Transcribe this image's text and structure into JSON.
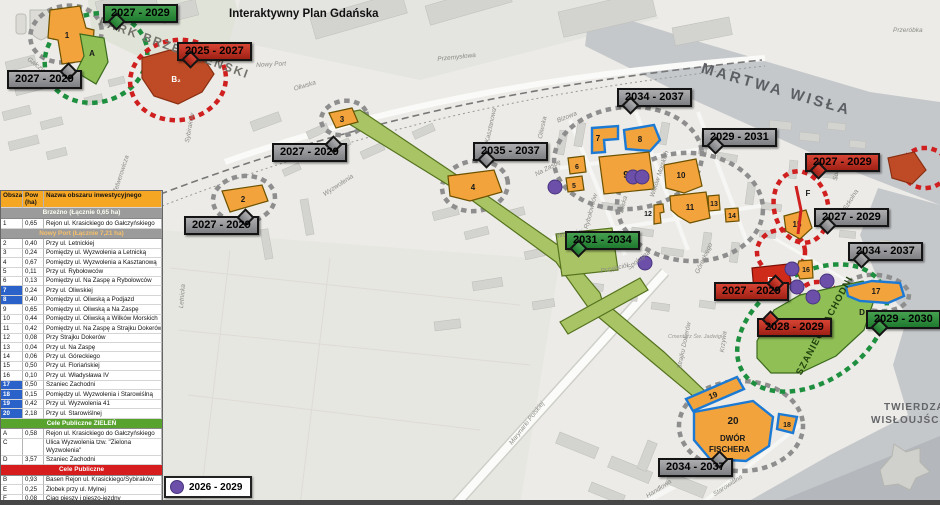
{
  "title": "Interaktywny Plan Gdańska",
  "legend_table": {
    "headers": [
      "Obszar",
      "Pow (ha)",
      "Nazwa obszaru inwestycyjnego"
    ],
    "rows": [
      {
        "section": "Brzeźno (Łącznie 0,65 ha)",
        "variant": "gray"
      },
      {
        "id": "1",
        "area": "0,65",
        "name": "Rejon ul. Krasickiego do Gałczyńskiego"
      },
      {
        "section": "Nowy Port (Łącznie 7,21 ha)",
        "variant": "gray2"
      },
      {
        "id": "2",
        "area": "0,40",
        "name": "Przy ul. Letnickiej"
      },
      {
        "id": "3",
        "area": "0,24",
        "name": "Pomiędzy ul. Wyzwolenia a Letnicką"
      },
      {
        "id": "4",
        "area": "0,67",
        "name": "Pomiędzy ul. Wyzwolenia a Kasztanową"
      },
      {
        "id": "5",
        "area": "0,11",
        "name": "Przy ul. Rybołowców"
      },
      {
        "id": "6",
        "area": "0,13",
        "name": "Pomiędzy ul. Na Zaspę a Rybołowców"
      },
      {
        "id": "7",
        "area": "0,24",
        "name": "Przy ul. Oliwskiej",
        "blue": true
      },
      {
        "id": "8",
        "area": "0,40",
        "name": "Pomiędzy ul. Oliwską a Podjazd",
        "blue": true
      },
      {
        "id": "9",
        "area": "0,65",
        "name": "Pomiędzy ul. Oliwską a Na Zaspę"
      },
      {
        "id": "10",
        "area": "0,44",
        "name": "Pomiędzy ul. Oliwską a Wilków Morskich"
      },
      {
        "id": "11",
        "area": "0,42",
        "name": "Pomiędzy ul. Na Zaspę a Strajku Dokerów"
      },
      {
        "id": "12",
        "area": "0,08",
        "name": "Przy Strajku Dokerów"
      },
      {
        "id": "13",
        "area": "0,04",
        "name": "Przy ul. Na Zaspę"
      },
      {
        "id": "14",
        "area": "0,06",
        "name": "Przy ul. Góreckiego"
      },
      {
        "id": "15",
        "area": "0,50",
        "name": "Przy ul. Floriańskiej"
      },
      {
        "id": "16",
        "area": "0,10",
        "name": "Przy ul. Władysława IV"
      },
      {
        "id": "17",
        "area": "0,50",
        "name": "Szaniec Zachodni",
        "blue": true
      },
      {
        "id": "18",
        "area": "0,15",
        "name": "Pomiędzy ul. Wyzwolenia i Starowiślną",
        "blue": true
      },
      {
        "id": "19",
        "area": "0,42",
        "name": "Przy ul. Wyzwolenia 41",
        "blue": true
      },
      {
        "id": "20",
        "area": "2,18",
        "name": "Przy ul. Starowiślnej",
        "blue": true
      },
      {
        "section": "Cele Publiczne ZIELEŃ",
        "variant": "green"
      },
      {
        "id": "A",
        "area": "0,58",
        "name": "Rejon ul. Krasickiego do Gałczyńskiego"
      },
      {
        "id": "C",
        "area": "",
        "name": "Ulica Wyzwolenia tzw. \"Zielona Wyzwolenia\""
      },
      {
        "id": "D",
        "area": "3,57",
        "name": "Szaniec Zachodni"
      },
      {
        "section": "Cele Publiczne",
        "variant": "red"
      },
      {
        "id": "B",
        "area": "0,93",
        "name": "Basen Rejon ul. Krasickiego/Sybiraków"
      },
      {
        "id": "E",
        "area": "0,25",
        "name": "Żłobek przy ul. Mylnej"
      },
      {
        "id": "F",
        "area": "0,08",
        "name": "Ciąg pieszy i pieszo-jezdny"
      },
      {
        "id": "",
        "area": "",
        "name": "PM nr 1 \"Tęczowa Jedyneczka\""
      },
      {
        "section": "Działki położone w granicach Portu Morskiego",
        "variant": "blue"
      }
    ]
  },
  "dot_legend": {
    "label": "2026 - 2029",
    "color": "#6b4fa8"
  },
  "callouts": [
    {
      "label": "2027 - 2029",
      "variant": "green",
      "x": 103,
      "y": 4,
      "tail": "bl"
    },
    {
      "label": "2025 - 2027",
      "variant": "red",
      "x": 177,
      "y": 42,
      "tail": "bl"
    },
    {
      "label": "2027 - 2029",
      "variant": "gray",
      "x": 7,
      "y": 70,
      "tail": "tr"
    },
    {
      "label": "2027 - 2029",
      "variant": "gray",
      "x": 272,
      "y": 143,
      "tail": "tr"
    },
    {
      "label": "2035 - 2037",
      "variant": "gray",
      "x": 473,
      "y": 142,
      "tail": "bl"
    },
    {
      "label": "2027 - 2029",
      "variant": "gray",
      "x": 184,
      "y": 216,
      "tail": "tr"
    },
    {
      "label": "2034 - 2037",
      "variant": "gray",
      "x": 617,
      "y": 88,
      "tail": "bl"
    },
    {
      "label": "2029 - 2031",
      "variant": "gray",
      "x": 702,
      "y": 128,
      "tail": "bl"
    },
    {
      "label": "2027 - 2029",
      "variant": "red",
      "x": 805,
      "y": 153,
      "tail": "bl"
    },
    {
      "label": "2031 - 2034",
      "variant": "green",
      "x": 565,
      "y": 231,
      "tail": "bl"
    },
    {
      "label": "2027 - 2029",
      "variant": "red",
      "x": 714,
      "y": 282,
      "tail": "tr"
    },
    {
      "label": "2027 - 2029",
      "variant": "gray",
      "x": 814,
      "y": 208,
      "tail": "bl"
    },
    {
      "label": "2034 - 2037",
      "variant": "gray",
      "x": 848,
      "y": 242,
      "tail": "bl"
    },
    {
      "label": "2028 - 2029",
      "variant": "red",
      "x": 757,
      "y": 318,
      "tail": "tl"
    },
    {
      "label": "2029 - 2030",
      "variant": "green",
      "x": 866,
      "y": 310,
      "tail": "bl"
    },
    {
      "label": "2034 - 2037",
      "variant": "gray",
      "x": 658,
      "y": 458,
      "tail": "tr"
    }
  ],
  "map_labels": [
    {
      "t": "Interaktywny Plan Gdańska",
      "x": 229,
      "y": 8,
      "r": 0,
      "cls": "maintitle"
    },
    {
      "t": "PARK BRZEŹNIEŃSKI",
      "x": 102,
      "y": 14,
      "r": 20,
      "cls": "parklbl"
    },
    {
      "t": "MARTWA WISŁA",
      "x": 704,
      "y": 60,
      "r": 16,
      "cls": "waterlbl"
    },
    {
      "t": "Przeróbka",
      "x": 893,
      "y": 27,
      "r": 0,
      "cls": "street"
    },
    {
      "t": "TWIERDZA",
      "x": 884,
      "y": 402,
      "r": 0,
      "cls": "fortlbl"
    },
    {
      "t": "WISŁOUJŚCIE",
      "x": 871,
      "y": 415,
      "r": 0,
      "cls": "fortlbl"
    },
    {
      "t": "SZANIEC ZACHODNI",
      "x": 794,
      "y": 372,
      "r": -62,
      "cls": "szaniec"
    },
    {
      "t": "DWÓR",
      "x": 720,
      "y": 434,
      "r": 0,
      "cls": "fischera"
    },
    {
      "t": "FISCHERA",
      "x": 709,
      "y": 445,
      "r": 0,
      "cls": "fischera"
    },
    {
      "t": "Nowy Port",
      "x": 256,
      "y": 62,
      "r": -3,
      "cls": "street"
    },
    {
      "t": "Przemysłowa",
      "x": 437,
      "y": 56,
      "r": -6,
      "cls": "street"
    },
    {
      "t": "Oliwska",
      "x": 293,
      "y": 86,
      "r": -17,
      "cls": "street"
    },
    {
      "t": "Oliwska",
      "x": 537,
      "y": 138,
      "r": -78,
      "cls": "street"
    },
    {
      "t": "Kasztanowa",
      "x": 484,
      "y": 142,
      "r": -78,
      "cls": "street"
    },
    {
      "t": "Sybiraków",
      "x": 184,
      "y": 142,
      "r": -80,
      "cls": "street"
    },
    {
      "t": "Zelwerowicza",
      "x": 112,
      "y": 192,
      "r": -72,
      "cls": "street"
    },
    {
      "t": "Letnicka",
      "x": 178,
      "y": 308,
      "r": -85,
      "cls": "street"
    },
    {
      "t": "Gałczyńskiego",
      "x": 30,
      "y": 56,
      "r": 38,
      "cls": "street"
    },
    {
      "t": "Wyzwolenia",
      "x": 322,
      "y": 192,
      "r": -33,
      "cls": "street"
    },
    {
      "t": "Bizowa",
      "x": 556,
      "y": 118,
      "r": -22,
      "cls": "street"
    },
    {
      "t": "Na Zaspę",
      "x": 534,
      "y": 172,
      "r": -28,
      "cls": "street"
    },
    {
      "t": "Wolności",
      "x": 556,
      "y": 233,
      "r": -10,
      "cls": "street"
    },
    {
      "t": "Rybołowców",
      "x": 583,
      "y": 228,
      "r": -75,
      "cls": "street"
    },
    {
      "t": "Bliska",
      "x": 618,
      "y": 212,
      "r": -75,
      "cls": "street"
    },
    {
      "t": "Wilków Morskich",
      "x": 649,
      "y": 196,
      "r": -72,
      "cls": "street"
    },
    {
      "t": "Góreckiego",
      "x": 694,
      "y": 272,
      "r": -65,
      "cls": "street"
    },
    {
      "t": "Przyjaciół",
      "x": 600,
      "y": 268,
      "r": -12,
      "cls": "street"
    },
    {
      "t": "Spokojna",
      "x": 626,
      "y": 266,
      "r": -38,
      "cls": "street"
    },
    {
      "t": "Strajku Dokerów",
      "x": 676,
      "y": 368,
      "r": -78,
      "cls": "street"
    },
    {
      "t": "Krzywa",
      "x": 719,
      "y": 352,
      "r": -83,
      "cls": "street"
    },
    {
      "t": "Solec",
      "x": 832,
      "y": 180,
      "r": -80,
      "cls": "street"
    },
    {
      "t": "Szkolna",
      "x": 842,
      "y": 208,
      "r": -58,
      "cls": "street"
    },
    {
      "t": "Marynarki Polskiej",
      "x": 508,
      "y": 442,
      "r": -52,
      "cls": "street"
    },
    {
      "t": "Handlowa",
      "x": 645,
      "y": 494,
      "r": -33,
      "cls": "street"
    },
    {
      "t": "Starowiślna",
      "x": 712,
      "y": 492,
      "r": -33,
      "cls": "street"
    },
    {
      "t": "Cmentarz Św. Jadwigi",
      "x": 668,
      "y": 334,
      "r": 0,
      "cls": "tinylbl"
    }
  ],
  "map": {
    "rings": [
      {
        "cx": 66,
        "cy": 34,
        "rx": 36,
        "ry": 28,
        "rot": -12,
        "c": "gray"
      },
      {
        "cx": 96,
        "cy": 58,
        "rx": 52,
        "ry": 44,
        "rot": -18,
        "c": "green"
      },
      {
        "cx": 178,
        "cy": 80,
        "rx": 48,
        "ry": 40,
        "rot": -8,
        "c": "red"
      },
      {
        "cx": 244,
        "cy": 199,
        "rx": 31,
        "ry": 23,
        "rot": -6,
        "c": "gray"
      },
      {
        "cx": 344,
        "cy": 118,
        "rx": 23,
        "ry": 17,
        "rot": -10,
        "c": "gray"
      },
      {
        "cx": 475,
        "cy": 186,
        "rx": 33,
        "ry": 25,
        "rot": -8,
        "c": "gray"
      },
      {
        "cx": 628,
        "cy": 158,
        "rx": 74,
        "ry": 51,
        "rot": -4,
        "c": "gray"
      },
      {
        "cx": 690,
        "cy": 207,
        "rx": 73,
        "ry": 54,
        "rot": 4,
        "c": "gray"
      },
      {
        "cx": 877,
        "cy": 293,
        "rx": 32,
        "ry": 18,
        "rot": 6,
        "c": "gray"
      },
      {
        "cx": 741,
        "cy": 426,
        "rx": 62,
        "ry": 45,
        "rot": 0,
        "c": "gray"
      },
      {
        "cx": 801,
        "cy": 207,
        "rx": 27,
        "ry": 36,
        "rot": -12,
        "c": "red"
      },
      {
        "cx": 781,
        "cy": 252,
        "rx": 24,
        "ry": 22,
        "rot": 0,
        "c": "red"
      },
      {
        "cx": 818,
        "cy": 300,
        "rx": 21,
        "ry": 18,
        "rot": 0,
        "c": "red"
      },
      {
        "cx": 925,
        "cy": 168,
        "rx": 23,
        "ry": 20,
        "rot": 0,
        "c": "red"
      },
      {
        "cx": 812,
        "cy": 328,
        "rx": 82,
        "ry": 54,
        "rot": -33,
        "c": "green"
      }
    ],
    "areas": [
      {
        "id": "C",
        "cls": "ar-c",
        "pts": "350,112 360,110 476,188 562,248 600,293 602,300 664,352 708,394 700,402 652,362 590,310 556,262 466,196 346,122",
        "lx": 606,
        "ly": 312
      },
      {
        "id": "",
        "cls": "ar-c",
        "pts": "560,322 640,278 648,290 568,334"
      },
      {
        "id": "",
        "cls": "ar-c",
        "pts": "556,234 612,228 618,270 562,276"
      },
      {
        "id": "D",
        "cls": "ar-g",
        "pts": "757,341 774,310 800,295 835,287 863,281 876,294 864,330 836,356 800,373 771,373 757,358",
        "lx": 862,
        "ly": 315
      },
      {
        "id": "1",
        "cls": "ar-o",
        "pts": "50,10 80,6 86,28 94,30 92,60 62,64 58,40 48,38",
        "lx": 67,
        "ly": 38
      },
      {
        "id": "A",
        "cls": "ar-g",
        "pts": "80,34 104,38 108,62 96,84 76,72 84,56",
        "lx": 92,
        "ly": 56
      },
      {
        "id": "B2",
        "label": "B₂",
        "cls": "ar-b",
        "pts": "142,58 170,50 202,56 214,74 202,92 178,104 154,96 142,78",
        "lx": 176,
        "ly": 82,
        "white": true
      },
      {
        "id": "2",
        "cls": "ar-o",
        "pts": "222,191 262,185 268,201 230,212",
        "lx": 243,
        "ly": 202
      },
      {
        "id": "3",
        "cls": "ar-o",
        "pts": "329,113 352,108 358,122 336,128",
        "lx": 342,
        "ly": 122
      },
      {
        "id": "4",
        "cls": "ar-o",
        "pts": "448,176 494,170 502,192 470,201 450,196",
        "lx": 473,
        "ly": 190
      },
      {
        "id": "5",
        "cls": "ar-o",
        "pts": "566,178 582,176 584,190 568,192",
        "lx": 574,
        "ly": 188,
        "sm": true
      },
      {
        "id": "6",
        "cls": "ar-o",
        "pts": "568,158 584,156 586,172 570,174",
        "lx": 577,
        "ly": 169,
        "sm": true
      },
      {
        "id": "7",
        "cls": "ar-ob",
        "pts": "592,128 618,126 618,139 604,140 605,152 592,153",
        "lx": 598,
        "ly": 141
      },
      {
        "id": "8",
        "cls": "ar-ob",
        "pts": "624,130 654,125 660,140 650,151 626,149",
        "lx": 640,
        "ly": 142
      },
      {
        "id": "9",
        "cls": "ar-o",
        "pts": "599,157 649,152 654,189 604,194",
        "lx": 626,
        "ly": 178,
        "big": true
      },
      {
        "id": "10",
        "cls": "ar-o",
        "pts": "664,165 696,159 702,186 684,193 666,188",
        "lx": 681,
        "ly": 178
      },
      {
        "id": "11",
        "cls": "ar-o",
        "pts": "670,196 706,192 710,218 690,223 678,216 671,210",
        "lx": 690,
        "ly": 210
      },
      {
        "id": "12",
        "cls": "ar-o",
        "pts": "654,205 663,204 664,212 660,213 661,223 654,224",
        "lx": 648,
        "ly": 216,
        "sm": true
      },
      {
        "id": "13",
        "cls": "ar-o",
        "pts": "708,196 719,195 720,210 709,211",
        "lx": 714,
        "ly": 206,
        "sm": true
      },
      {
        "id": "14",
        "cls": "ar-o",
        "pts": "725,209 738,208 739,221 726,222",
        "lx": 732,
        "ly": 218,
        "sm": true
      },
      {
        "id": "15",
        "cls": "ar-o",
        "pts": "784,216 806,210 812,228 800,239 786,231",
        "lx": 797,
        "ly": 227
      },
      {
        "id": "16",
        "cls": "ar-o",
        "pts": "799,261 812,260 813,278 800,279 796,270",
        "lx": 806,
        "ly": 272,
        "sm": true
      },
      {
        "id": "17",
        "cls": "ar-ob",
        "pts": "846,287 872,281 900,283 904,296 888,303 860,301 848,296",
        "lx": 876,
        "ly": 294
      },
      {
        "id": "18",
        "cls": "ar-ob",
        "pts": "779,414 797,417 793,433 777,429",
        "lx": 787,
        "ly": 427,
        "sm": true
      },
      {
        "id": "19",
        "cls": "ar-ob",
        "pts": "686,399 737,377 744,389 693,411",
        "lx": 714,
        "ly": 398,
        "rot": -22
      },
      {
        "id": "20",
        "cls": "ar-ob",
        "pts": "694,412 753,401 773,417 769,446 746,461 710,459 694,440",
        "lx": 733,
        "ly": 424,
        "big": true
      },
      {
        "id": "E",
        "cls": "ar-r",
        "pts": "752,268 788,264 791,283 774,296 754,291",
        "lx": 770,
        "ly": 283,
        "white": true
      },
      {
        "id": "F",
        "cls": "ar-line",
        "line": "796,186 801,210 798,234",
        "lx": 808,
        "ly": 196
      },
      {
        "id": "",
        "cls": "ar-b",
        "pts": "888,158 914,152 926,170 912,184 892,178"
      }
    ],
    "purple_dots": [
      [
        555,
        187
      ],
      [
        633,
        177
      ],
      [
        642,
        177
      ],
      [
        645,
        263
      ],
      [
        792,
        269
      ],
      [
        797,
        287
      ],
      [
        827,
        281
      ],
      [
        813,
        297
      ]
    ],
    "colors": {
      "orange_area": "#f2a33c",
      "blue_outline": "#1c7ad4",
      "green_area": "#8fbf55",
      "red_area": "#cf2b1a",
      "brick_area": "#bf4b26",
      "purple_dot": "#6b4fa8",
      "gray_ring": "#8e8e8e",
      "red_ring": "#cf1f1f",
      "green_ring": "#1e8f3e",
      "water": "#c5c8cb"
    }
  }
}
